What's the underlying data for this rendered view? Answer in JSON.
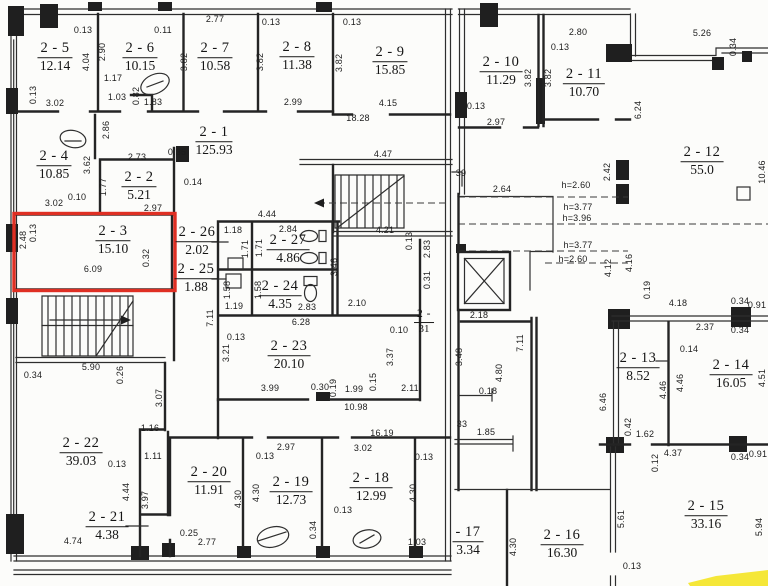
{
  "plan": {
    "type": "floorplan-scan",
    "floor_prefix": "2",
    "selected_room": "2 - 3",
    "selected_room_area": "15.10",
    "highlight_color": "#df2f23",
    "marker_color": "#f4e41d",
    "features": [
      "staircase-top",
      "staircase-bottom",
      "elevator-shaft",
      "toilet-fixtures",
      "yellow-highlighter-mark"
    ]
  },
  "rooms": [
    {
      "label": "2 - 5",
      "area": "12.14",
      "x": 55,
      "y": 57
    },
    {
      "label": "2 - 6",
      "area": "10.15",
      "x": 140,
      "y": 57
    },
    {
      "label": "2 - 7",
      "area": "10.58",
      "x": 215,
      "y": 57
    },
    {
      "label": "2 - 8",
      "area": "11.38",
      "x": 297,
      "y": 56
    },
    {
      "label": "2 - 9",
      "area": "15.85",
      "x": 390,
      "y": 61
    },
    {
      "label": "2 - 1",
      "area": "125.93",
      "x": 214,
      "y": 141
    },
    {
      "label": "2 - 4",
      "area": "10.85",
      "x": 54,
      "y": 165
    },
    {
      "label": "2 - 2",
      "area": "5.21",
      "x": 139,
      "y": 186
    },
    {
      "label": "2 - 3",
      "area": "15.10",
      "x": 113,
      "y": 240,
      "highlight": true
    },
    {
      "label": "2 - 26",
      "area": "2.02",
      "x": 197,
      "y": 241
    },
    {
      "label": "2 - 25",
      "area": "1.88",
      "x": 196,
      "y": 278
    },
    {
      "label": "2 - 27",
      "area": "4.86",
      "x": 288,
      "y": 249
    },
    {
      "label": "2 - 24",
      "area": "4.35",
      "x": 280,
      "y": 295
    },
    {
      "label": "2 - 23",
      "area": "20.10",
      "x": 289,
      "y": 355
    },
    {
      "label": "2 -",
      "area": "31",
      "x": 424,
      "y": 322,
      "small": true
    },
    {
      "label": "2 - 22",
      "area": "39.03",
      "x": 81,
      "y": 452
    },
    {
      "label": "2 - 21",
      "area": "4.38",
      "x": 107,
      "y": 526
    },
    {
      "label": "2 - 20",
      "area": "11.91",
      "x": 209,
      "y": 481
    },
    {
      "label": "2 - 19",
      "area": "12.73",
      "x": 291,
      "y": 491
    },
    {
      "label": "2 - 18",
      "area": "12.99",
      "x": 371,
      "y": 487
    },
    {
      "label": "2 - 10",
      "area": "11.29",
      "x": 501,
      "y": 71
    },
    {
      "label": "2 - 11",
      "area": "10.70",
      "x": 584,
      "y": 83
    },
    {
      "label": "2 - 12",
      "area": "55.0",
      "x": 702,
      "y": 161
    },
    {
      "label": "2 - 13",
      "area": "8.52",
      "x": 638,
      "y": 367
    },
    {
      "label": "2 - 14",
      "area": "16.05",
      "x": 731,
      "y": 374
    },
    {
      "label": "2 - 15",
      "area": "33.16",
      "x": 706,
      "y": 515
    },
    {
      "label": "2 - 16",
      "area": "16.30",
      "x": 562,
      "y": 544
    },
    {
      "label": "- 17",
      "area": "3.34",
      "x": 468,
      "y": 541
    }
  ],
  "dims": [
    [
      "0.13",
      83,
      30,
      0
    ],
    [
      "0.11",
      163,
      30,
      0
    ],
    [
      "2.77",
      215,
      19,
      0
    ],
    [
      "0.13",
      271,
      22,
      0
    ],
    [
      "0.13",
      352,
      22,
      0
    ],
    [
      "3.02",
      55,
      103,
      0
    ],
    [
      "1.17",
      113,
      78,
      0
    ],
    [
      "1.03",
      117,
      97,
      0
    ],
    [
      "1.83",
      153,
      102,
      0
    ],
    [
      "2.99",
      293,
      102,
      0
    ],
    [
      "4.15",
      388,
      103,
      0
    ],
    [
      "18.28",
      358,
      118,
      0
    ],
    [
      "2.80",
      578,
      32,
      0
    ],
    [
      "0.13",
      560,
      47,
      0
    ],
    [
      "0.13",
      476,
      106,
      0
    ],
    [
      "2.97",
      496,
      122,
      0
    ],
    [
      "5.26",
      702,
      33,
      0
    ],
    [
      "2.73",
      137,
      157,
      0
    ],
    [
      "0.35",
      177,
      152,
      0
    ],
    [
      "0.10",
      77,
      197,
      0
    ],
    [
      "3.02",
      54,
      203,
      0
    ],
    [
      "2.97",
      153,
      208,
      0
    ],
    [
      "0.14",
      193,
      182,
      0
    ],
    [
      "6.09",
      93,
      269,
      0
    ],
    [
      "4.44",
      267,
      214,
      0
    ],
    [
      "1.18",
      233,
      230,
      0
    ],
    [
      "2.84",
      288,
      229,
      0
    ],
    [
      "4.47",
      383,
      154,
      0
    ],
    [
      "4.21",
      385,
      230,
      0
    ],
    [
      "2.64",
      502,
      189,
      0
    ],
    [
      "39",
      461,
      173,
      0
    ],
    [
      "2.10",
      357,
      303,
      0
    ],
    [
      "6.28",
      301,
      322,
      0
    ],
    [
      "0.10",
      399,
      330,
      0
    ],
    [
      "0.13",
      236,
      337,
      0
    ],
    [
      "3.99",
      270,
      388,
      0
    ],
    [
      "0.30",
      320,
      387,
      0
    ],
    [
      "1.99",
      354,
      389,
      0
    ],
    [
      "2.11",
      410,
      388,
      0
    ],
    [
      "10.98",
      356,
      407,
      0
    ],
    [
      "1.19",
      234,
      306,
      0
    ],
    [
      "2.83",
      307,
      307,
      0
    ],
    [
      "2.18",
      479,
      315,
      0
    ],
    [
      "0.18",
      488,
      391,
      0
    ],
    [
      "1.85",
      486,
      432,
      0
    ],
    [
      "33",
      462,
      424,
      0
    ],
    [
      "5.90",
      91,
      367,
      0
    ],
    [
      "0.34",
      33,
      375,
      0
    ],
    [
      "1.16",
      150,
      428,
      0
    ],
    [
      "1.11",
      153,
      456,
      0
    ],
    [
      "0.13",
      117,
      464,
      0
    ],
    [
      "0.25",
      189,
      533,
      0
    ],
    [
      "2.77",
      207,
      542,
      0
    ],
    [
      "4.74",
      73,
      541,
      0
    ],
    [
      "16.19",
      382,
      433,
      0
    ],
    [
      "2.97",
      286,
      447,
      0
    ],
    [
      "3.02",
      363,
      448,
      0
    ],
    [
      "0.13",
      265,
      456,
      0
    ],
    [
      "0.13",
      424,
      457,
      0
    ],
    [
      "0.13",
      343,
      510,
      0
    ],
    [
      "1.03",
      417,
      542,
      0
    ],
    [
      "4.18",
      678,
      303,
      0
    ],
    [
      "0.34",
      740,
      301,
      0
    ],
    [
      "0.91",
      757,
      305,
      0
    ],
    [
      "2.37",
      705,
      327,
      0
    ],
    [
      "0.34",
      740,
      330,
      0
    ],
    [
      "0.14",
      689,
      349,
      0
    ],
    [
      "1.62",
      645,
      434,
      0
    ],
    [
      "4.37",
      673,
      453,
      0
    ],
    [
      "0.34",
      740,
      457,
      0
    ],
    [
      "0.91",
      758,
      454,
      0
    ],
    [
      "0.13",
      632,
      566,
      0
    ],
    [
      "h=2.60",
      576,
      185,
      0
    ],
    [
      "h=3.77",
      578,
      207,
      0
    ],
    [
      "h=3.96",
      577,
      218,
      0
    ],
    [
      "h=3.77",
      578,
      245,
      0
    ],
    [
      "h=2.60",
      573,
      259,
      0
    ],
    [
      "2.90",
      102,
      52,
      1
    ],
    [
      "4.04",
      86,
      62,
      1
    ],
    [
      "3.82",
      184,
      62,
      1
    ],
    [
      "0.82",
      136,
      96,
      1
    ],
    [
      "0.13",
      33,
      95,
      1
    ],
    [
      "2.86",
      106,
      130,
      1
    ],
    [
      "3.82",
      260,
      62,
      1
    ],
    [
      "3.82",
      339,
      63,
      1
    ],
    [
      "3.82",
      528,
      78,
      1
    ],
    [
      "3.82",
      548,
      78,
      1
    ],
    [
      "0.34",
      733,
      47,
      1
    ],
    [
      "6.24",
      638,
      110,
      1
    ],
    [
      "10.46",
      762,
      172,
      1
    ],
    [
      "3.62",
      87,
      165,
      1
    ],
    [
      "1.77",
      103,
      187,
      1
    ],
    [
      "2.48",
      23,
      240,
      1
    ],
    [
      "0.13",
      33,
      233,
      1
    ],
    [
      "0.32",
      146,
      258,
      1
    ],
    [
      "1.71",
      245,
      249,
      1
    ],
    [
      "1.71",
      259,
      248,
      1
    ],
    [
      "1.58",
      227,
      290,
      1
    ],
    [
      "1.58",
      258,
      290,
      1
    ],
    [
      "3.46",
      334,
      267,
      1
    ],
    [
      "7.11",
      210,
      318,
      1
    ],
    [
      "3.21",
      226,
      353,
      1
    ],
    [
      "3.37",
      390,
      357,
      1
    ],
    [
      "0.19",
      333,
      388,
      1
    ],
    [
      "0.15",
      373,
      382,
      1
    ],
    [
      "0.13",
      409,
      241,
      1
    ],
    [
      "2.83",
      427,
      249,
      1
    ],
    [
      "0.31",
      427,
      280,
      1
    ],
    [
      "7.11",
      520,
      343,
      1
    ],
    [
      "4.80",
      499,
      373,
      1
    ],
    [
      "3.48",
      459,
      357,
      1
    ],
    [
      "2.42",
      607,
      172,
      1
    ],
    [
      "4.12",
      608,
      268,
      1
    ],
    [
      "4.16",
      629,
      263,
      1
    ],
    [
      "0.19",
      647,
      290,
      1
    ],
    [
      "4.46",
      663,
      390,
      1
    ],
    [
      "4.46",
      680,
      383,
      1
    ],
    [
      "4.51",
      762,
      378,
      1
    ],
    [
      "6.46",
      603,
      402,
      1
    ],
    [
      "0.42",
      628,
      427,
      1
    ],
    [
      "0.26",
      120,
      375,
      1
    ],
    [
      "3.07",
      159,
      398,
      1
    ],
    [
      "4.44",
      126,
      492,
      1
    ],
    [
      "3.97",
      145,
      500,
      1
    ],
    [
      "4.30",
      238,
      499,
      1
    ],
    [
      "4.30",
      256,
      493,
      1
    ],
    [
      "4.30",
      413,
      493,
      1
    ],
    [
      "0.34",
      313,
      530,
      1
    ],
    [
      "0.12",
      655,
      463,
      1
    ],
    [
      "5.61",
      621,
      519,
      1
    ],
    [
      "5.94",
      759,
      527,
      1
    ],
    [
      "4.30",
      513,
      547,
      1
    ]
  ]
}
